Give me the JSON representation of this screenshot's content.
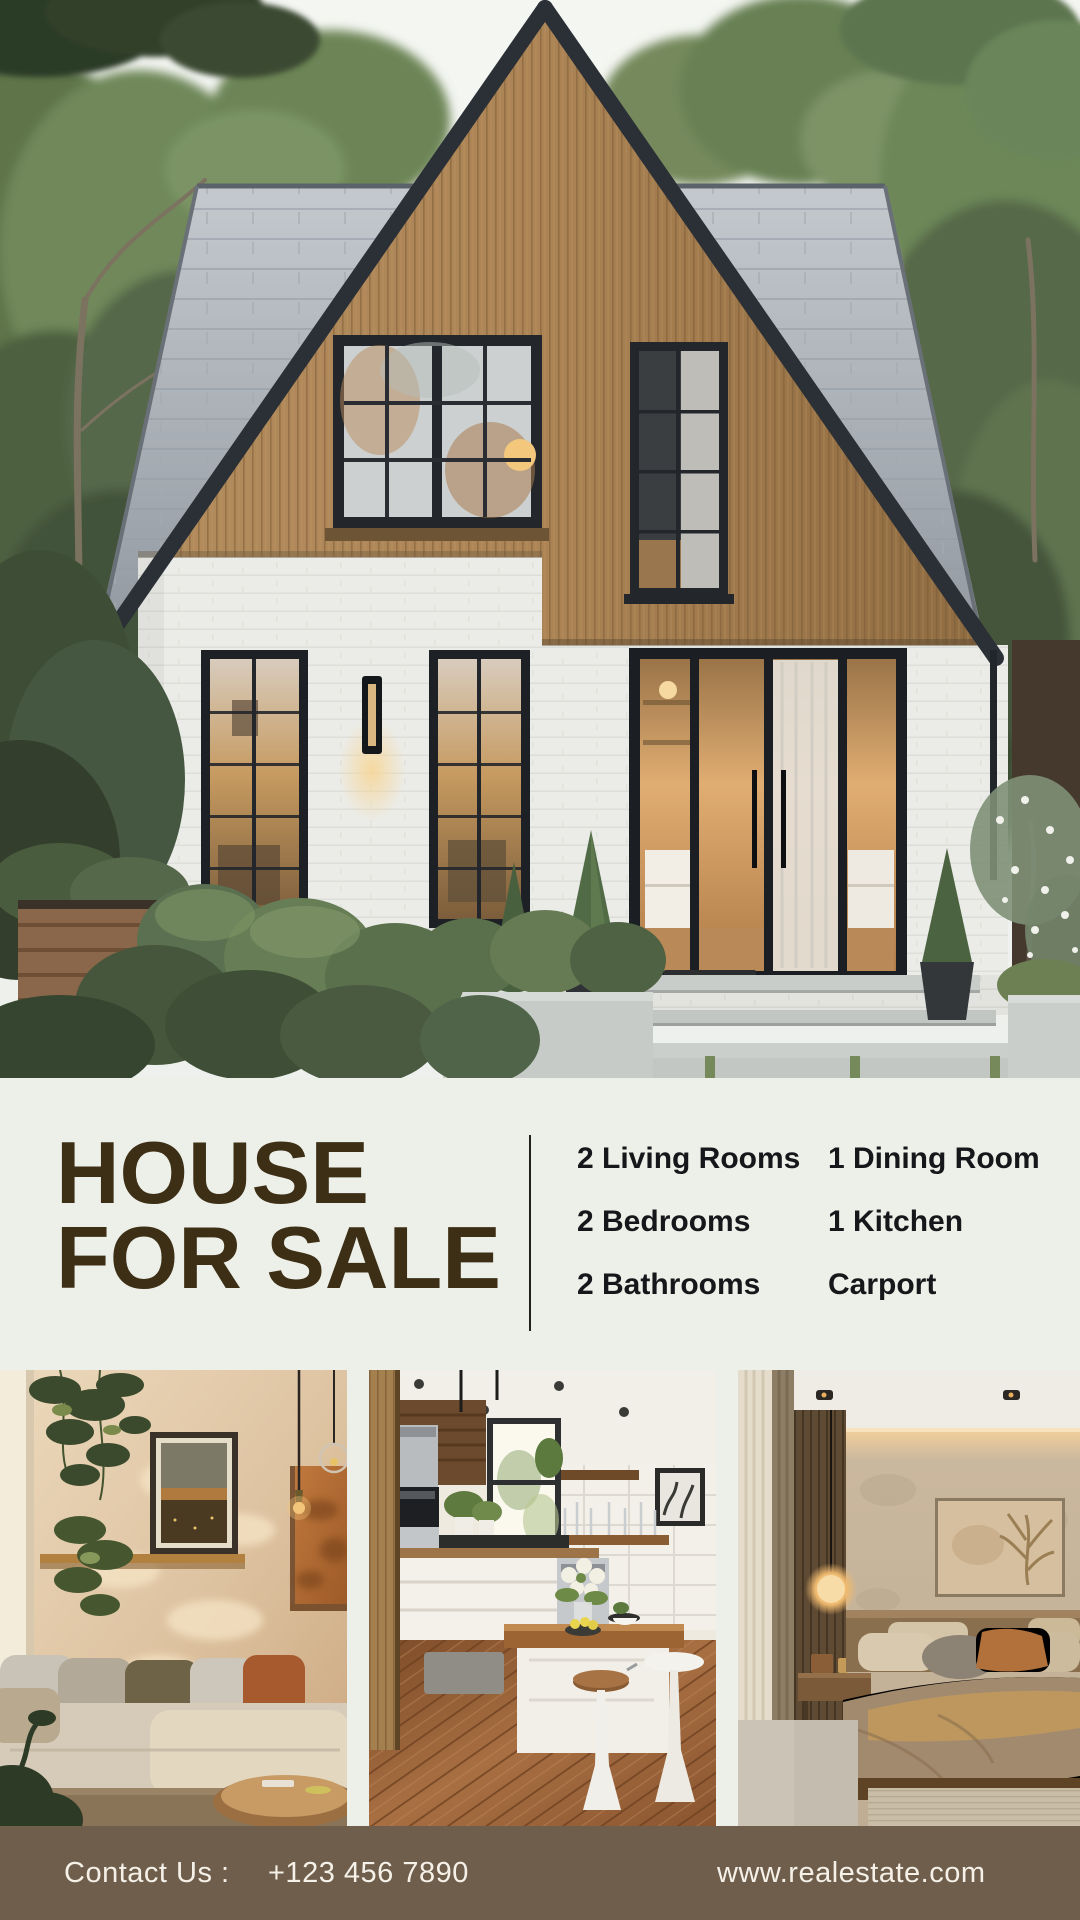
{
  "theme": {
    "page_bg": "#edf0e9",
    "title_color": "#3d2f16",
    "feature_color": "#16171a",
    "divider_color": "#22211b",
    "footer_bg": "#6f5e4c",
    "footer_text": "#f5f1e8"
  },
  "title": {
    "line1": "HOUSE",
    "line2": "FOR SALE"
  },
  "features": {
    "items": [
      "2 Living Rooms",
      "1 Dining Room",
      "2 Bedrooms",
      "1 Kitchen",
      "2 Bathrooms",
      "Carport"
    ]
  },
  "hero": {
    "description": "modern-a-frame-house-exterior-photo"
  },
  "gallery": {
    "photos": [
      "living-room-photo",
      "kitchen-photo",
      "bedroom-photo"
    ]
  },
  "footer": {
    "contact_label": "Contact Us :",
    "phone": "+123 456 7890",
    "website": "www.realestate.com"
  }
}
